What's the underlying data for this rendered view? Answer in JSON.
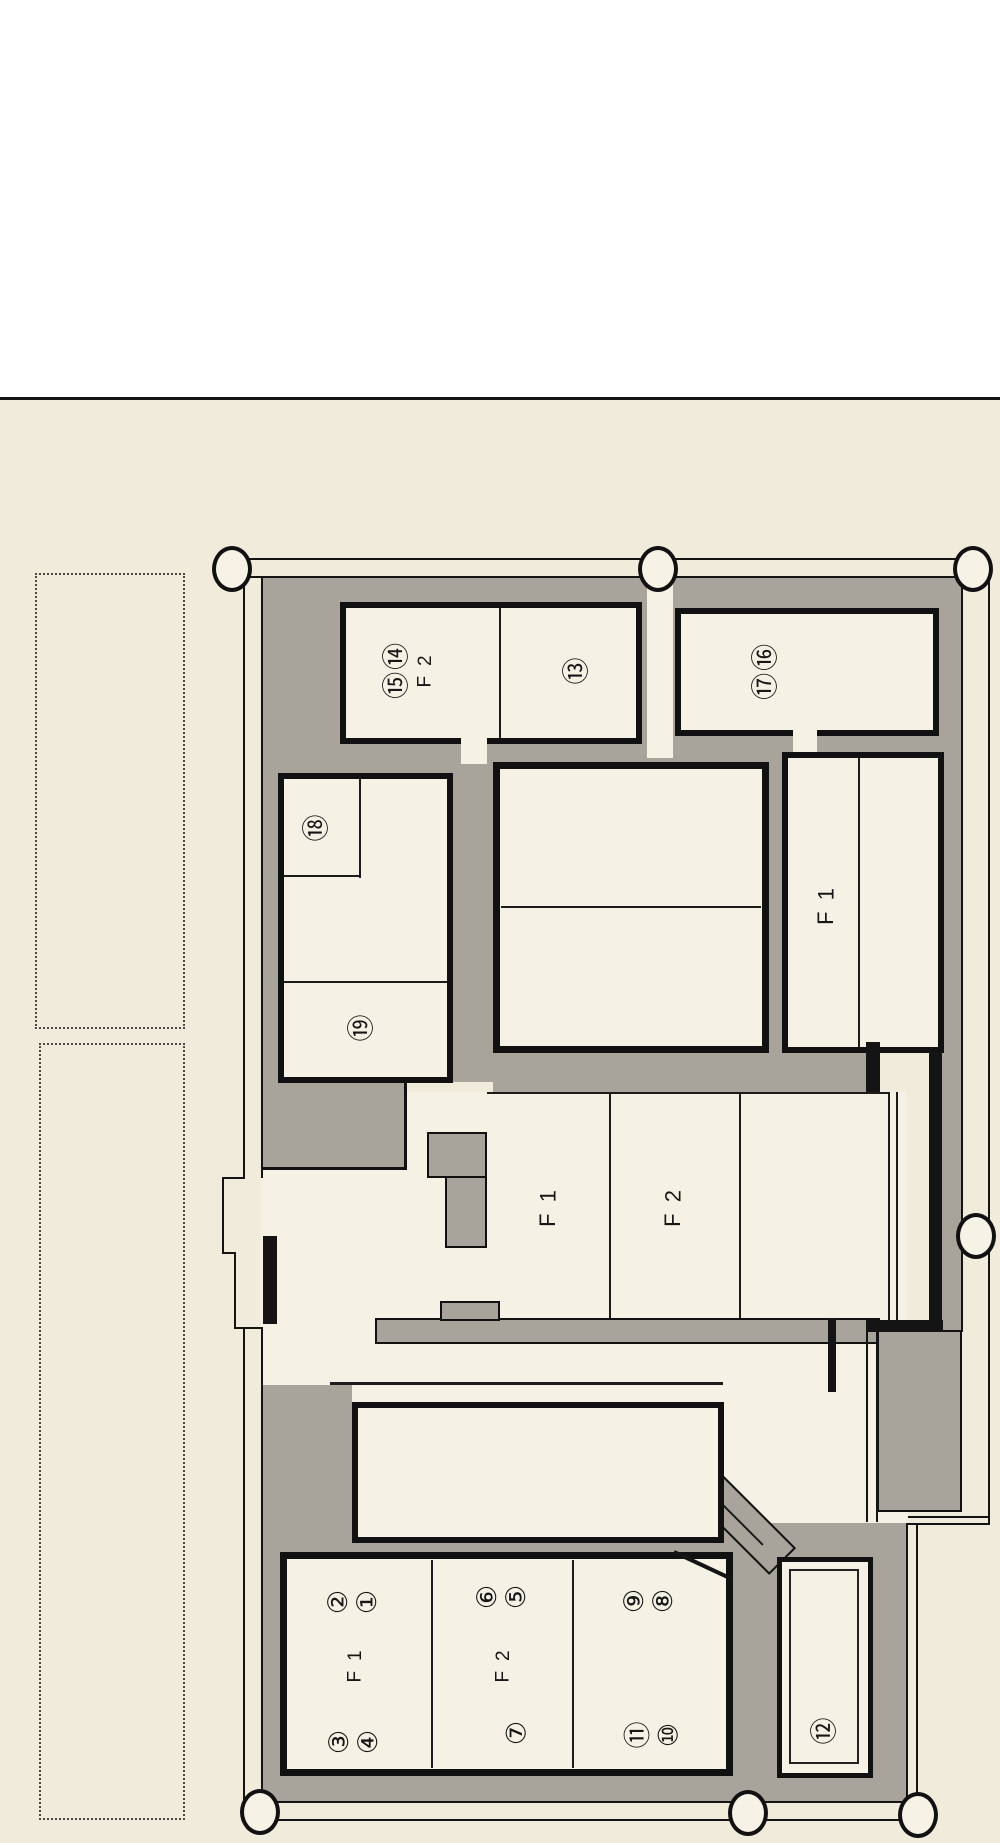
{
  "colors": {
    "sheet_top": "#ffffff",
    "sheet_bottom": "#f0ebdb",
    "floor_fill": "#f5f1e4",
    "wall_gray": "#a9a49b",
    "line_black": "#141414"
  },
  "plan": {
    "room_top_left": {
      "floor": "2F",
      "units_pair": "⑭⑮",
      "unit_right": "⑬"
    },
    "room_top_right": {
      "units_pair": "⑯⑰"
    },
    "room_mid_left": {
      "unit_upper": "⑱",
      "unit_lower": "⑲"
    },
    "strip_right": {
      "floor": "1F"
    },
    "mid_band": {
      "floor_left": "1F",
      "floor_right": "2F"
    },
    "bottom_block": {
      "sec1": {
        "units_top": "②①",
        "floor": "1F",
        "units_bottom": "③④"
      },
      "sec2": {
        "units_top": "⑥⑤",
        "floor": "2F",
        "units_bottom": "⑦"
      },
      "sec3": {
        "units_top": "⑨⑧",
        "units_bottom": "⑪⑩"
      }
    },
    "room_12": {
      "unit": "⑫"
    }
  }
}
